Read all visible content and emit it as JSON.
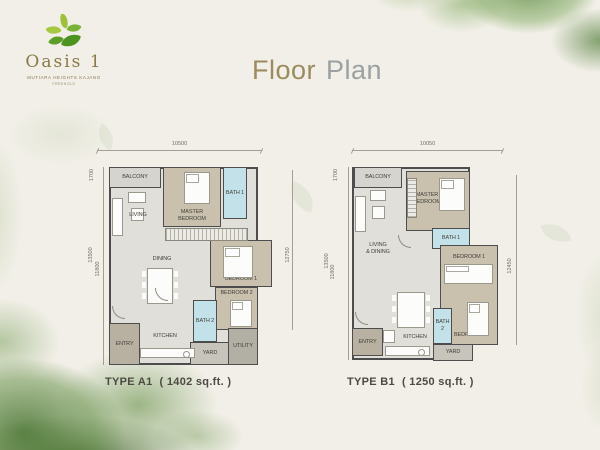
{
  "logo": {
    "name": "Oasis 1",
    "tagline": "MUTIARA HEIGHTS KAJANG",
    "subtagline": "FREEHOLD"
  },
  "title": {
    "part1": "Floor",
    "part2": "Plan"
  },
  "colors": {
    "background": "#f1efe7",
    "wall": "#4d4d4d",
    "floor_fill": "#e0dfda",
    "bedroom_fill": "#c9c0ae",
    "bath_fill": "#c2e1e8",
    "balcony_fill": "#d5d4cf",
    "entry_fill": "#b8b1a2",
    "utility_fill": "#b2afa5",
    "yard_fill": "#c6c4bb",
    "watercolor_green": "#6e9b49",
    "logo_green_light": "#a5c93e",
    "logo_green_dark": "#4c9422",
    "logo_text": "#8b7947",
    "title_floor": "#9c8b5e",
    "title_plan": "#9ba0a2"
  },
  "plans": [
    {
      "type_label": "TYPE A1",
      "area_label": "( 1402 sq.ft. )",
      "dims": {
        "width": "10500",
        "balcony": "1700",
        "overall": "13500",
        "inner": "11800",
        "right": "12750"
      },
      "rooms": {
        "balcony": "BALCONY",
        "living": "LIVING",
        "master_bedroom": "MASTER\nBEDROOM",
        "bath1": "BATH 1",
        "dining": "DINING",
        "bedroom1": "BEDROOM 1",
        "bedroom2": "BEDROOM 2",
        "bath2": "BATH 2",
        "entry": "ENTRY",
        "kitchen": "KITCHEN",
        "yard": "YARD",
        "utility": "UTILITY"
      }
    },
    {
      "type_label": "TYPE B1",
      "area_label": "( 1250 sq.ft. )",
      "dims": {
        "width": "10050",
        "balcony": "1700",
        "overall": "13500",
        "inner": "11800",
        "right": "12450"
      },
      "rooms": {
        "balcony": "BALCONY",
        "living_dining": "LIVING\n& DINING",
        "master_bedroom": "MASTER\nBEDROOM",
        "bath1": "BATH 1",
        "bedroom1": "BEDROOM 1",
        "bedroom2": "BEDROOM 2",
        "bath2": "BATH 2",
        "entry": "ENTRY",
        "kitchen": "KITCHEN",
        "yard": "YARD"
      }
    }
  ]
}
